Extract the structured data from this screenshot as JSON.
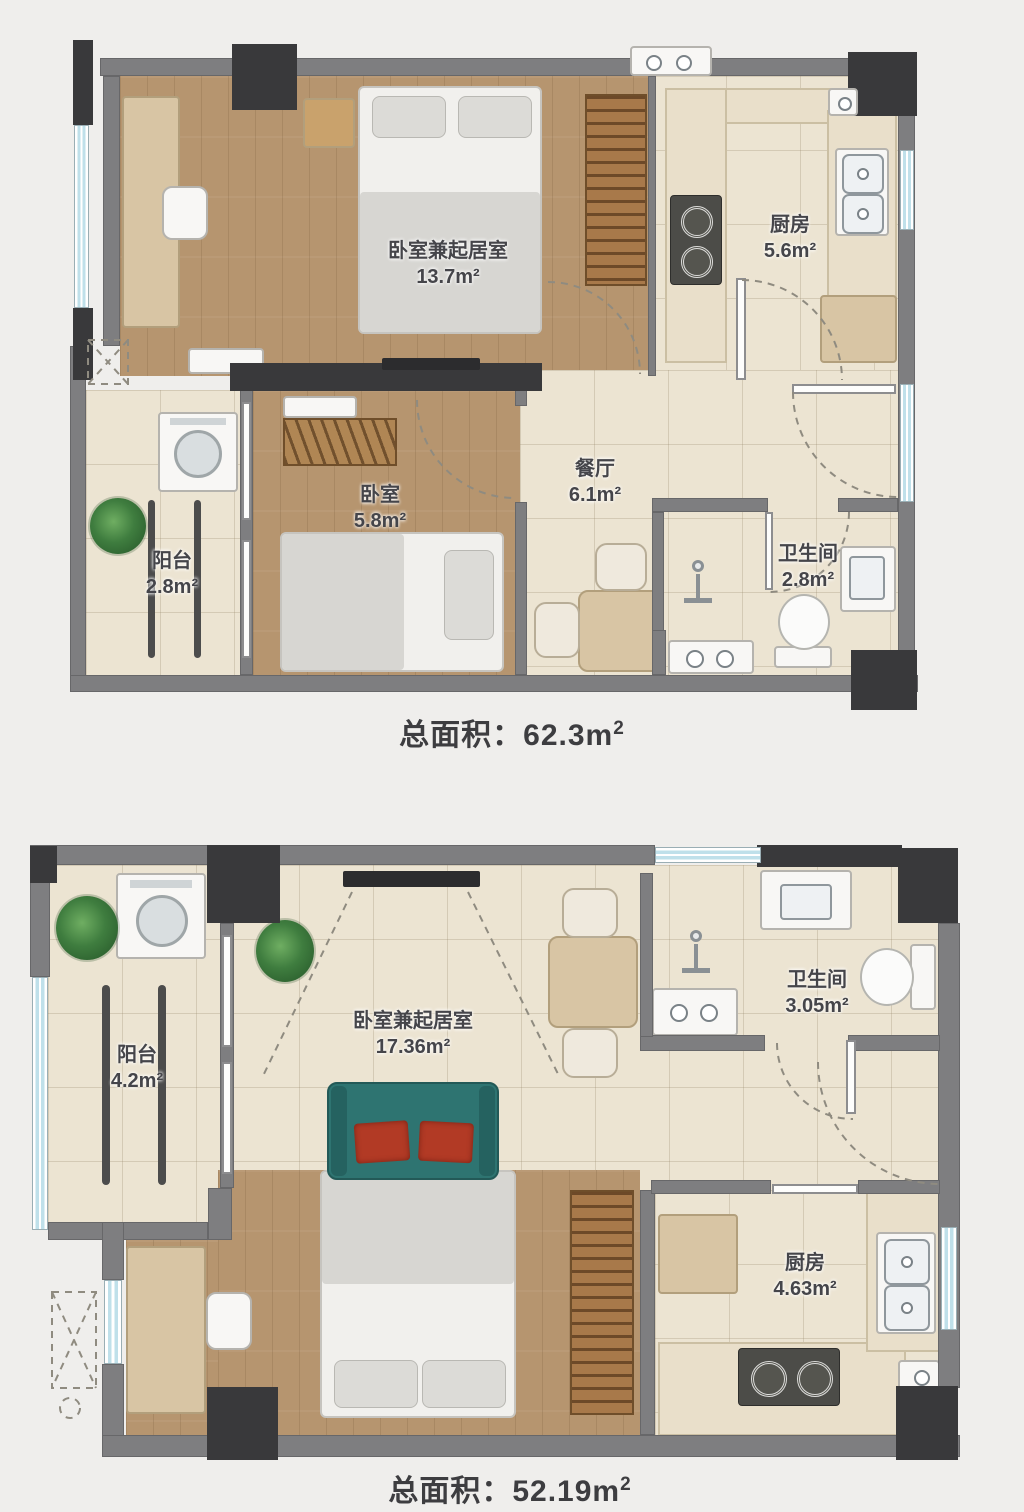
{
  "plans": [
    {
      "id": "plan-1",
      "rooms": [
        {
          "key": "bedroom-living",
          "name": "卧室兼起居室",
          "area": "13.7m²"
        },
        {
          "key": "kitchen",
          "name": "厨房",
          "area": "5.6m²"
        },
        {
          "key": "dining",
          "name": "餐厅",
          "area": "6.1m²"
        },
        {
          "key": "bedroom",
          "name": "卧室",
          "area": "5.8m²"
        },
        {
          "key": "balcony",
          "name": "阳台",
          "area": "2.8m²"
        },
        {
          "key": "bathroom",
          "name": "卫生间",
          "area": "2.8m²"
        }
      ],
      "total": {
        "label": "总面积：",
        "value": "62.3m",
        "sup": "2"
      }
    },
    {
      "id": "plan-2",
      "rooms": [
        {
          "key": "balcony",
          "name": "阳台",
          "area": "4.2m²"
        },
        {
          "key": "bedroom-living",
          "name": "卧室兼起居室",
          "area": "17.36m²"
        },
        {
          "key": "bathroom",
          "name": "卫生间",
          "area": "3.05m²"
        },
        {
          "key": "kitchen",
          "name": "厨房",
          "area": "4.63m²"
        }
      ],
      "total": {
        "label": "总面积：",
        "value": "52.19m",
        "sup": "2"
      }
    }
  ],
  "colors": {
    "wall": "#7e7e80",
    "column": "#39393b",
    "wood_floor": "#b6956f",
    "tile_floor": "#ece4d2",
    "sofa_teal": "#2e7471",
    "cushion_red": "#b23a25",
    "window_blue": "#bfe0ea",
    "label_text": "#45454a"
  }
}
